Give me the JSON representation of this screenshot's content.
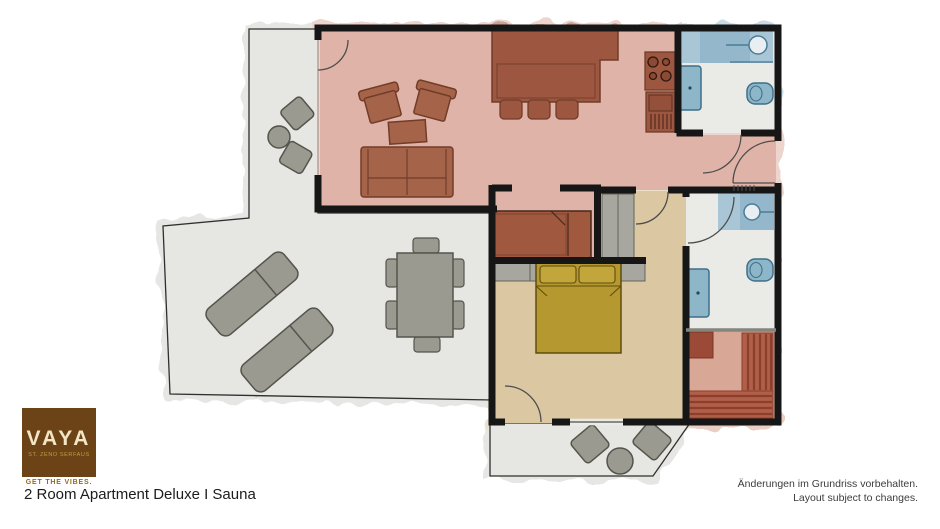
{
  "branding": {
    "name": "VAYA",
    "location": "ST. ZENO SERFAUS",
    "tagline": "GET THE VIBES."
  },
  "caption": "2 Room Apartment Deluxe I Sauna",
  "disclaimer": {
    "de": "Änderungen im Grundriss vorbehalten.",
    "en": "Layout subject to changes."
  },
  "colors": {
    "brand_brown": "#6b4316",
    "brand_cream": "#f2e6c5",
    "brand_gold": "#8f6d1f",
    "wall": "#161616",
    "living_room_floor": "#dfb3a7",
    "wood_furniture": "#9d5640",
    "bedroom_floor": "#dbc8a2",
    "bed": "#b5982f",
    "bathroom_fixture": "#8eb6c9",
    "terrace": "#e6e6e3",
    "sauna_floor": "#d9a795",
    "sauna_wood": "#b05f48"
  }
}
